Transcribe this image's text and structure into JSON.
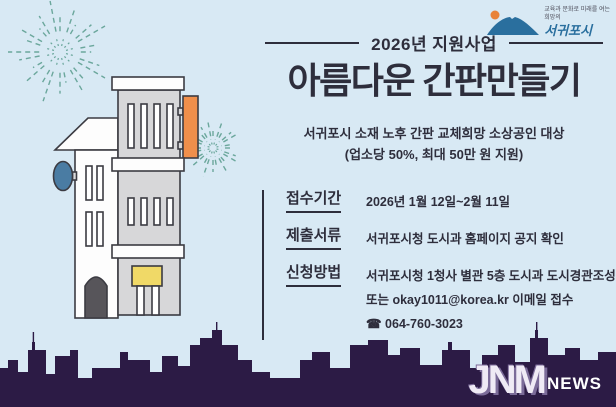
{
  "poster": {
    "program_header": "2026년 지원사업",
    "title": "아름다운 간판만들기",
    "subtitle_line1": "서귀포시 소재 노후 간판 교체희망 소상공인 대상",
    "subtitle_line2": "(업소당 50%, 최대 50만 원 지원)",
    "sections": [
      {
        "label": "접수기간",
        "lines": [
          "2026년 1월 12일~2월 11일"
        ]
      },
      {
        "label": "제출서류",
        "lines": [
          "서귀포시청 도시과 홈페이지 공지 확인"
        ]
      },
      {
        "label": "신청방법",
        "lines": [
          "서귀포시청 1청사 별관 5층 도시과 도시경관조성팀 방문,",
          "또는 okay1011@korea.kr 이메일 접수",
          "☎ 064-760-3023"
        ]
      }
    ]
  },
  "city_logo": {
    "slogan_line1": "교육과 문화로 미래를 여는",
    "slogan_line2": "희망의",
    "city_name": "서귀포시"
  },
  "watermark": {
    "brand": "JNM",
    "suffix": "NEWS"
  },
  "colors": {
    "bg": "#d8e9f4",
    "ink": "#2e2e3c",
    "line": "#3b3b42",
    "skyline": "#2c1b45",
    "firework": "#6ba79c",
    "sign_orange": "#ef8f4b",
    "sign_blue": "#4a7ca3",
    "sign_yellow": "#f0d967",
    "logo_mountain": "#2a6f9e",
    "logo_sun": "#e8833a",
    "jnm_purple": "#7b6b99"
  }
}
